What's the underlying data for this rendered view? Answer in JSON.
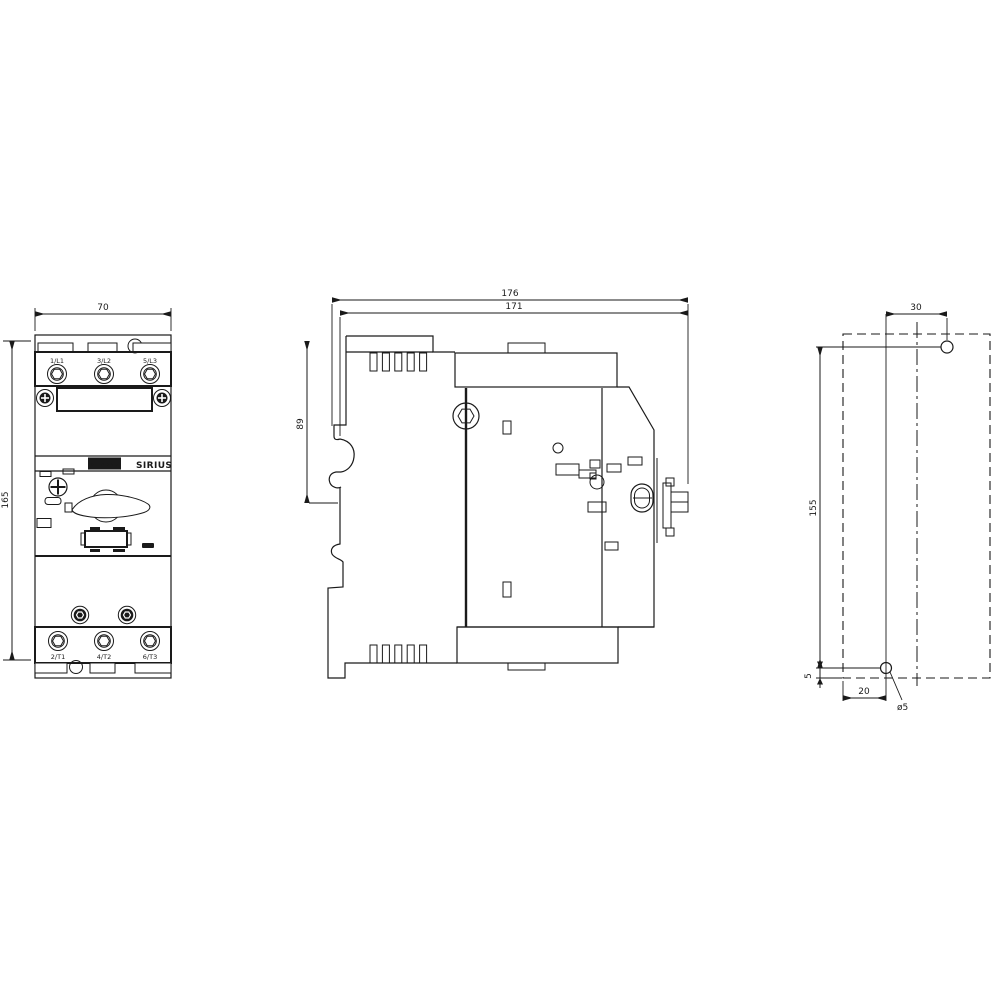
{
  "colors": {
    "line": "#1a1a1a",
    "background": "#ffffff"
  },
  "front_view": {
    "dim_width": "70",
    "dim_height": "165",
    "terminals_top": [
      "1/L1",
      "3/L2",
      "5/L3"
    ],
    "terminals_bottom": [
      "2/T1",
      "4/T2",
      "6/T3"
    ],
    "brand": "SIEMENS",
    "series": "SIRIUS"
  },
  "side_view": {
    "dim_overall_depth": "176",
    "dim_depth": "171",
    "dim_rail_height": "89"
  },
  "drill_plan": {
    "dim_hole_offset_x": "30",
    "dim_hole_pitch_y": "155",
    "dim_bottom_offset": "5",
    "dim_left_offset": "20",
    "hole_diameter": "ø5"
  }
}
